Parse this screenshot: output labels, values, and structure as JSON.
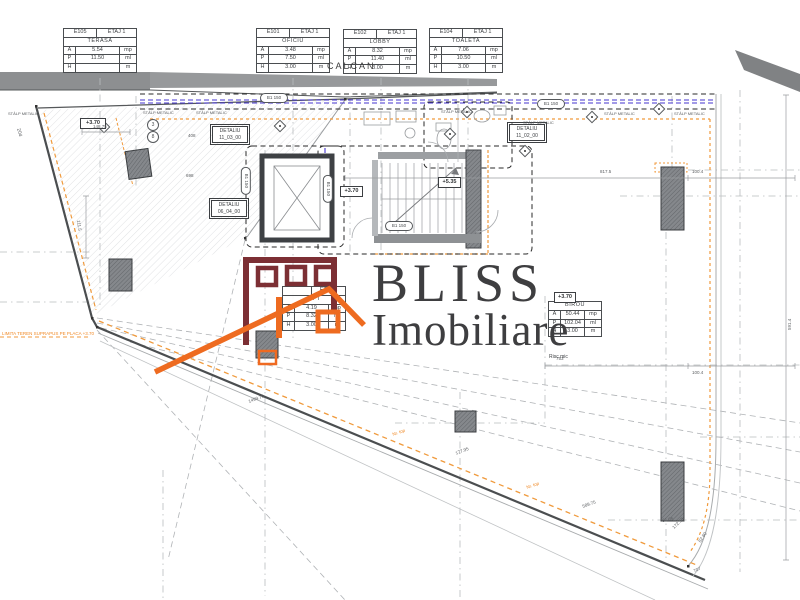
{
  "logo": {
    "brand": "BLISS",
    "brand_sub": "Imobiliare",
    "colors": {
      "building": "#7c2f34",
      "roof": "#ee6b20",
      "text": "#3e3e40"
    }
  },
  "colors": {
    "wall_dashed_blue": "#4636cf",
    "accent_orange": "#f09a3c",
    "gray_band": "#8d8f91",
    "column_fill": "#7b7e82",
    "line_dark": "#4b4e50",
    "line_light": "#b9bcbf"
  },
  "room_tables": [
    {
      "x": 63,
      "y": 28,
      "w": 74,
      "header": true,
      "id": "E105",
      "floor": "ETAJ 1",
      "name": "TERASA",
      "rows": [
        [
          "A",
          "5.54",
          "mp"
        ],
        [
          "P",
          "11.50",
          "ml"
        ],
        [
          "H",
          "",
          "m"
        ]
      ]
    },
    {
      "x": 256,
      "y": 28,
      "w": 74,
      "header": true,
      "id": "E101",
      "floor": "ETAJ 1",
      "name": "OFICIU",
      "rows": [
        [
          "A",
          "3.48",
          "mp"
        ],
        [
          "P",
          "7.50",
          "ml"
        ],
        [
          "H",
          "3.00",
          "m"
        ]
      ]
    },
    {
      "x": 343,
      "y": 29,
      "w": 74,
      "header": true,
      "id": "E102",
      "floor": "ETAJ 1",
      "name": "LOBBY",
      "rows": [
        [
          "A",
          "8.32",
          "mp"
        ],
        [
          "P",
          "11.40",
          "ml"
        ],
        [
          "H",
          "3.00",
          "m"
        ]
      ]
    },
    {
      "x": 429,
      "y": 28,
      "w": 74,
      "header": true,
      "id": "E104",
      "floor": "ETAJ 1",
      "name": "TOALETA",
      "rows": [
        [
          "A",
          "7.06",
          "mp"
        ],
        [
          "P",
          "10.50",
          "ml"
        ],
        [
          "H",
          "3.00",
          "m"
        ]
      ]
    },
    {
      "x": 282,
      "y": 286,
      "w": 64,
      "header": true,
      "id": "",
      "floor": "ETAJ 1",
      "name": "LIFT",
      "rows": [
        [
          "A",
          "4.19",
          "mp"
        ],
        [
          "P",
          "8.32",
          "ml"
        ],
        [
          "H",
          "3.00",
          "m"
        ]
      ]
    },
    {
      "x": 548,
      "y": 301,
      "w": 54,
      "header": false,
      "id": "",
      "floor": "",
      "name": "BIROU",
      "rows": [
        [
          "A",
          "50.44",
          "mp"
        ],
        [
          "P",
          "102.04",
          "ml"
        ],
        [
          "H",
          "3.00",
          "m"
        ]
      ]
    }
  ],
  "detail_boxes": [
    {
      "line1": "DETALIU",
      "line2": "11_03_00",
      "x": 212,
      "y": 126,
      "w": 34
    },
    {
      "line1": "DETALIU",
      "line2": "11_02_00",
      "x": 509,
      "y": 124,
      "w": 34
    },
    {
      "line1": "DETALIU",
      "line2": "06_04_00",
      "x": 211,
      "y": 200,
      "w": 34
    }
  ],
  "level_markers": [
    {
      "text": "+3.70",
      "x": 80,
      "y": 118,
      "w": 24
    },
    {
      "text": "+3.70",
      "x": 340,
      "y": 186,
      "w": 21
    },
    {
      "text": "+5.35",
      "x": 438,
      "y": 177,
      "w": 21
    },
    {
      "text": "+3.70",
      "x": 554,
      "y": 292,
      "w": 20
    }
  ],
  "callouts": [
    {
      "text": "B1 150",
      "x": 260,
      "y": 93,
      "w": 26,
      "r": 0
    },
    {
      "text": "B1 150",
      "x": 537,
      "y": 99,
      "w": 26,
      "r": 0
    },
    {
      "text": "B1 150",
      "x": 385,
      "y": 221,
      "w": 26,
      "r": 0
    },
    {
      "text": "B1 150",
      "x": 232,
      "y": 176,
      "w": 26,
      "r": 90
    },
    {
      "text": "B1 150",
      "x": 314,
      "y": 184,
      "w": 26,
      "r": 90
    }
  ],
  "grid_bubbles": [
    {
      "text": "3",
      "x": 147,
      "y": 119
    },
    {
      "text": "8",
      "x": 147,
      "y": 131
    }
  ],
  "labels": [
    {
      "text": "CALCAN",
      "x": 327,
      "y": 62,
      "s": 9,
      "c": "#3c3c3c",
      "ls": 2
    },
    {
      "text": "STÂLP METALIC",
      "x": 8,
      "y": 112,
      "s": 4
    },
    {
      "text": "STÂLP METALIC",
      "x": 143,
      "y": 111,
      "s": 4
    },
    {
      "text": "STÂLP METALIC",
      "x": 196,
      "y": 111,
      "s": 4
    },
    {
      "text": "STÂLP METALIC",
      "x": 441,
      "y": 110,
      "s": 4
    },
    {
      "text": "STÂLP METALIC",
      "x": 523,
      "y": 121,
      "s": 4
    },
    {
      "text": "STÂLP METALIC",
      "x": 604,
      "y": 112,
      "s": 4
    },
    {
      "text": "STÂLP METALIC",
      "x": 674,
      "y": 112,
      "s": 4
    },
    {
      "text": "Risc mic",
      "x": 549,
      "y": 355,
      "s": 5,
      "c": "#3c3f42"
    },
    {
      "text": "LIMITA TEREN SUPRAPUS PE PLACA +3.70",
      "x": 2,
      "y": 332,
      "s": 4.5,
      "c": "#f08a28"
    },
    {
      "text": "Nr. top",
      "x": 392,
      "y": 433,
      "s": 4.5,
      "c": "#f08a28",
      "r": -19
    },
    {
      "text": "Nr. top",
      "x": 526,
      "y": 486,
      "s": 4.5,
      "c": "#f08a28",
      "r": -19
    },
    {
      "text": "204",
      "x": 20,
      "y": 128,
      "s": 5,
      "r": 75
    },
    {
      "text": "148.75",
      "x": 93,
      "y": 125,
      "s": 4.5
    },
    {
      "text": "408",
      "x": 188,
      "y": 134,
      "s": 4.5
    },
    {
      "text": "698",
      "x": 186,
      "y": 174,
      "s": 4.5
    },
    {
      "text": "817.5",
      "x": 600,
      "y": 170,
      "s": 4.5
    },
    {
      "text": "100.4",
      "x": 692,
      "y": 170,
      "s": 4.5
    },
    {
      "text": "753",
      "x": 556,
      "y": 357,
      "s": 4.5
    },
    {
      "text": "100.4",
      "x": 692,
      "y": 371,
      "s": 4.5
    },
    {
      "text": "111.5",
      "x": 80,
      "y": 220,
      "s": 4.5,
      "r": 82
    },
    {
      "text": "1499.75",
      "x": 248,
      "y": 400,
      "s": 4.5,
      "r": -20
    },
    {
      "text": "177.95",
      "x": 455,
      "y": 452,
      "s": 4.5,
      "r": -21
    },
    {
      "text": "589.75",
      "x": 582,
      "y": 505,
      "s": 4.5,
      "r": -20
    },
    {
      "text": "707",
      "x": 693,
      "y": 570,
      "s": 4.5,
      "r": -27
    },
    {
      "text": "172.53",
      "x": 672,
      "y": 527,
      "s": 4.5,
      "r": -45
    },
    {
      "text": "82.80",
      "x": 698,
      "y": 541,
      "s": 4.5,
      "r": -55
    },
    {
      "text": "61.05",
      "x": 662,
      "y": 519,
      "s": 4.5,
      "r": -10
    },
    {
      "text": "591.4",
      "x": 788,
      "y": 330,
      "s": 4.5,
      "r": -90
    }
  ]
}
